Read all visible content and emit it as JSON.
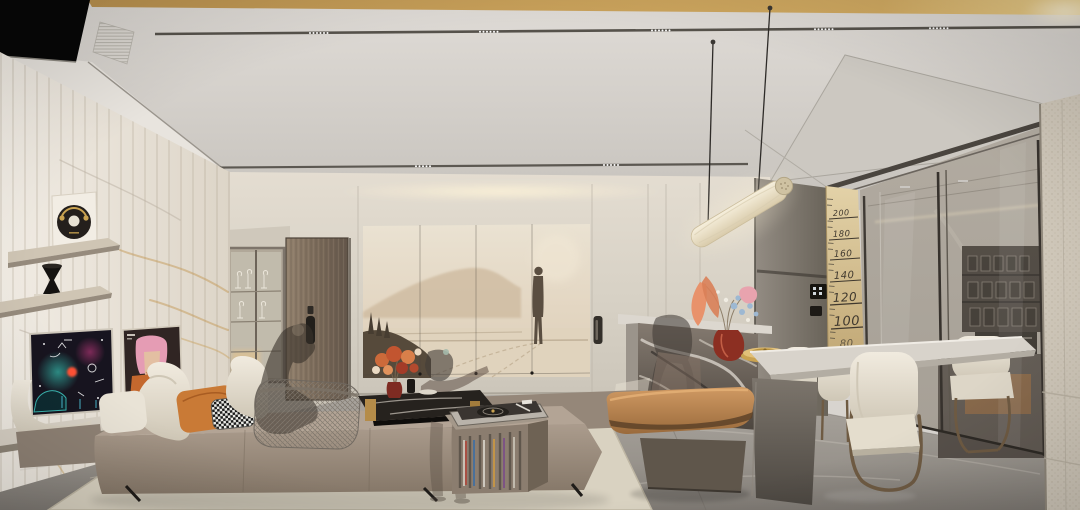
{
  "scene": {
    "description": "Photorealistic 3D interior render of a modern light-luxury living and dining room",
    "style": "contemporary cream, taupe and bronze palette with marble surfaces",
    "figures": "semi-transparent ghost entourage people"
  },
  "height_ruler": {
    "marks": [
      "200",
      "180",
      "160",
      "140",
      "120",
      "100",
      "80"
    ]
  },
  "palette": {
    "gold_trim": "#c9a254",
    "ceiling": "#d8d4cf",
    "marble_wall": "#efeae2",
    "marble_vein_gold": "#c49a58",
    "back_wall": "#d9d3c8",
    "sofa_leather": "#9c8d7f",
    "headrest_cream": "#ece6d9",
    "pillow_orange": "#c97a36",
    "bench_leather": "#b8834f",
    "coffee_table_marble": "#221e1b",
    "gold_leg": "#b58c49",
    "dining_chair": "#e9e3d7",
    "bronze_frame": "#6f5b43",
    "floor_marble": "#a5a099",
    "rug": "#d9d2c1",
    "glass_partition": "#847b70",
    "ruler_wood": "#dcc89b",
    "ruler_ink": "#3f382e",
    "pendant_tube": "#efe5cd"
  },
  "artworks": {
    "mural": "misty sepia landscape with a lone walking figure",
    "poster_galaxy": "dark cosmic poster with neon doodles",
    "poster_portrait": "pop portrait of a pink-haired woman",
    "vinyl_disc": "black record disc wall art with headphones motif"
  },
  "objects": [
    "tube-pendant-light",
    "ceiling-light-tracks",
    "ac-vents",
    "wall-shelves",
    "hourglass-vase",
    "media-ledge",
    "sofa",
    "wireframe-armchair",
    "coffee-table",
    "flower-bouquet",
    "turntable",
    "vinyl-records",
    "leather-bench",
    "kitchen-island",
    "island-vase",
    "gold-tray",
    "dining-table",
    "dining-chairs",
    "height-ruler",
    "glass-partition",
    "kitchen-shelf-jars",
    "wine-glass-cabinet",
    "entry-door",
    "concealed-door",
    "leather-column",
    "area-rug"
  ]
}
